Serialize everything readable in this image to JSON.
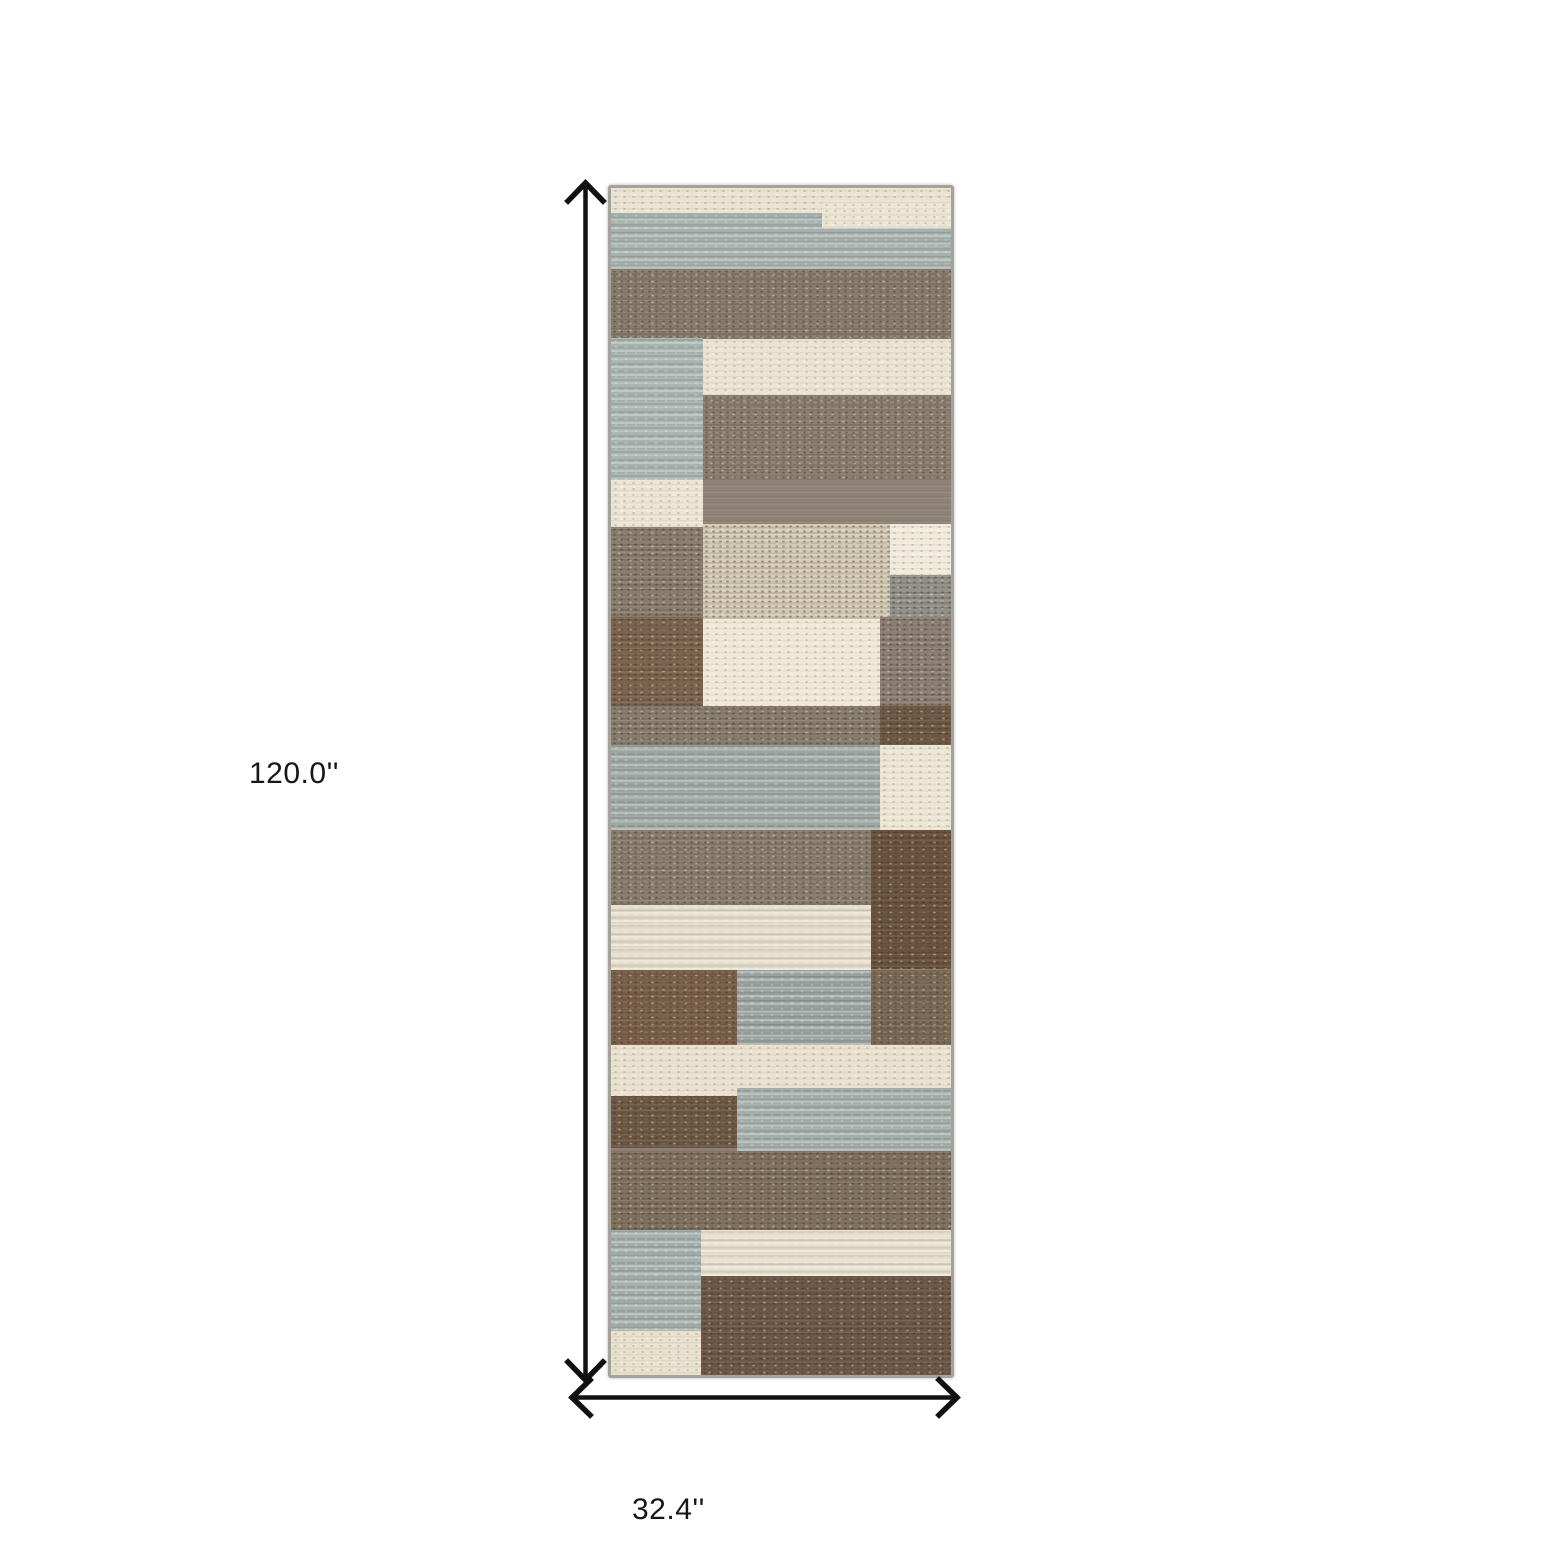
{
  "image_type": "product dimension diagram of a runner rug",
  "canvas": {
    "width": 1560,
    "height": 1560,
    "background": "#ffffff"
  },
  "dimensions": {
    "height": {
      "label": "120.0''",
      "orientation": "vertical"
    },
    "width": {
      "label": "32.4''",
      "orientation": "horizontal"
    }
  },
  "arrow_color": "#111111",
  "rug": {
    "left": 608,
    "top": 185,
    "width": 340,
    "height": 1187,
    "border_color": "#a5a29b",
    "base_color": "#8d8275",
    "palette": {
      "cream": "#ebe3d1",
      "bright_cream": "#f1ebdc",
      "sage_gray": "#a6b1ae",
      "blue_gray_band": "#9da7a3",
      "taupe": "#897e6f",
      "tan_mix": "#d8cfba",
      "brown": "#7b604a",
      "dark_brown": "#6b523d"
    },
    "patches": [
      {
        "x": 0,
        "y": 0,
        "w": 100,
        "h": 2.8,
        "color": "#ebe3d1",
        "texture": "grain"
      },
      {
        "x": 0,
        "y": 2.1,
        "w": 100,
        "h": 4.7,
        "color": "#a6b1ae",
        "texture": "streak"
      },
      {
        "x": 62,
        "y": 1.2,
        "w": 38,
        "h": 2.2,
        "color": "#ece5d3",
        "texture": "grain"
      },
      {
        "x": 0,
        "y": 6.8,
        "w": 100,
        "h": 6.0,
        "color": "#887d6e",
        "texture": "speckle"
      },
      {
        "x": 0,
        "y": 12.6,
        "w": 27,
        "h": 15.4,
        "color": "#a8b4b0",
        "texture": "streak"
      },
      {
        "x": 27,
        "y": 12.7,
        "w": 73,
        "h": 4.7,
        "color": "#ebe4d1",
        "texture": "grain"
      },
      {
        "x": 27,
        "y": 17.4,
        "w": 73,
        "h": 7.3,
        "color": "#8d8173",
        "texture": "speckle"
      },
      {
        "x": 0,
        "y": 24.6,
        "w": 27,
        "h": 4.0,
        "color": "#ece5d3",
        "texture": "grain"
      },
      {
        "x": 0,
        "y": 28.6,
        "w": 27,
        "h": 7.5,
        "color": "#8a7f70",
        "texture": "speckle"
      },
      {
        "x": 27,
        "y": 28.3,
        "w": 55,
        "h": 8.0,
        "color": "#d8cfba",
        "texture": "speckle"
      },
      {
        "x": 82,
        "y": 28.3,
        "w": 18,
        "h": 4.3,
        "color": "#f1ebdc",
        "texture": "grain"
      },
      {
        "x": 82,
        "y": 32.6,
        "w": 18,
        "h": 3.7,
        "color": "#95948c",
        "texture": "speckle"
      },
      {
        "x": 0,
        "y": 36.1,
        "w": 27,
        "h": 7.5,
        "color": "#7e644e",
        "texture": "speckle"
      },
      {
        "x": 27,
        "y": 36.3,
        "w": 52,
        "h": 7.3,
        "color": "#f0e9d8",
        "texture": "grain"
      },
      {
        "x": 79,
        "y": 36.1,
        "w": 21,
        "h": 7.5,
        "color": "#8c8174",
        "texture": "speckle"
      },
      {
        "x": 0,
        "y": 43.6,
        "w": 79,
        "h": 3.3,
        "color": "#897e6f",
        "texture": "speckle"
      },
      {
        "x": 79,
        "y": 43.6,
        "w": 21,
        "h": 3.3,
        "color": "#6f5844",
        "texture": "speckle"
      },
      {
        "x": 0,
        "y": 46.9,
        "w": 79,
        "h": 7.2,
        "color": "#9da7a3",
        "texture": "streak"
      },
      {
        "x": 79,
        "y": 46.9,
        "w": 21,
        "h": 7.2,
        "color": "#ece6d4",
        "texture": "grain"
      },
      {
        "x": 0,
        "y": 54.1,
        "w": 77,
        "h": 6.3,
        "color": "#8a7f71",
        "texture": "speckle"
      },
      {
        "x": 76.5,
        "y": 54.1,
        "w": 23.5,
        "h": 11.7,
        "color": "#6b523d",
        "texture": "speckle"
      },
      {
        "x": 0,
        "y": 60.4,
        "w": 76.5,
        "h": 5.5,
        "color": "#e7dfcc",
        "texture": "streak"
      },
      {
        "x": 0,
        "y": 65.9,
        "w": 37,
        "h": 6.3,
        "color": "#7b604a",
        "texture": "speckle"
      },
      {
        "x": 37,
        "y": 65.9,
        "w": 39.5,
        "h": 6.3,
        "color": "#99a29f",
        "texture": "streak"
      },
      {
        "x": 76.5,
        "y": 65.9,
        "w": 23.5,
        "h": 6.3,
        "color": "#7c6a56",
        "texture": "speckle"
      },
      {
        "x": 0,
        "y": 72.2,
        "w": 100,
        "h": 4.3,
        "color": "#eae2cf",
        "texture": "grain"
      },
      {
        "x": 0,
        "y": 76.5,
        "w": 37,
        "h": 4.4,
        "color": "#6f5944",
        "texture": "speckle"
      },
      {
        "x": 37,
        "y": 75.8,
        "w": 63,
        "h": 5.3,
        "color": "#a3aeab",
        "texture": "streak"
      },
      {
        "x": 0,
        "y": 81.1,
        "w": 100,
        "h": 6.7,
        "color": "#80725e",
        "texture": "speckle"
      },
      {
        "x": 0,
        "y": 87.8,
        "w": 26.5,
        "h": 8.5,
        "color": "#a3aeab",
        "texture": "streak"
      },
      {
        "x": 26.5,
        "y": 87.8,
        "w": 73.5,
        "h": 3.9,
        "color": "#e8e1ce",
        "texture": "streak"
      },
      {
        "x": 26.5,
        "y": 91.7,
        "w": 73.5,
        "h": 8.3,
        "color": "#6e5845",
        "texture": "speckle"
      },
      {
        "x": 0,
        "y": 96.3,
        "w": 26.5,
        "h": 3.7,
        "color": "#e9e1cd",
        "texture": "grain"
      }
    ]
  }
}
